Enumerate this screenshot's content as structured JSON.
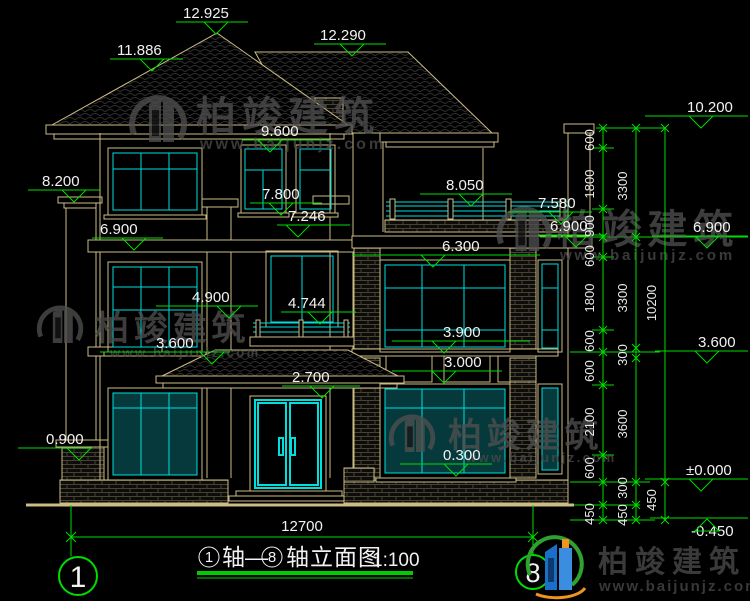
{
  "drawing_title": {
    "axis_left": "1",
    "between": "轴—",
    "axis_right": "8",
    "suffix": "轴立面图",
    "scale": "1:100"
  },
  "axis_bubbles": {
    "left": "1",
    "right": "8"
  },
  "bottom_dim": "12700",
  "elevations": [
    {
      "t": "12.925",
      "x": 183,
      "y": 18,
      "l1": 176,
      "l2": 248,
      "tx": 216
    },
    {
      "t": "11.886",
      "x": 117,
      "y": 55,
      "l1": 110,
      "l2": 183,
      "tx": 152
    },
    {
      "t": "12.290",
      "x": 320,
      "y": 40,
      "l1": 314,
      "l2": 386,
      "tx": 352
    },
    {
      "t": "9.600",
      "x": 261,
      "y": 136,
      "l1": 242,
      "l2": 330,
      "tx": 270
    },
    {
      "t": "8.200",
      "x": 42,
      "y": 186,
      "l1": 28,
      "l2": 100,
      "tx": 74
    },
    {
      "t": "7.800",
      "x": 262,
      "y": 199,
      "l1": 250,
      "l2": 322,
      "tx": 281
    },
    {
      "t": "7.246",
      "x": 288,
      "y": 221,
      "l1": 277,
      "l2": 350,
      "tx": 298
    },
    {
      "t": "8.050",
      "x": 446,
      "y": 190,
      "l1": 420,
      "l2": 512,
      "tx": 471
    },
    {
      "t": "7.580",
      "x": 538,
      "y": 208,
      "l1": 508,
      "l2": 592,
      "tx": 561
    },
    {
      "t": "6.900",
      "x": 100,
      "y": 234,
      "l1": 92,
      "l2": 163,
      "tx": 134
    },
    {
      "t": "6.900",
      "x": 550,
      "y": 231,
      "l1": 538,
      "l2": 606,
      "tx": 576
    },
    {
      "t": "6.900",
      "x": 693,
      "y": 232,
      "l1": 652,
      "l2": 748,
      "tx": 707
    },
    {
      "t": "10.200",
      "x": 687,
      "y": 112,
      "l1": 645,
      "l2": 748,
      "tx": 701
    },
    {
      "t": "6.300",
      "x": 442,
      "y": 251,
      "l1": 352,
      "l2": 540,
      "tx": 433
    },
    {
      "t": "4.900",
      "x": 192,
      "y": 302,
      "l1": 156,
      "l2": 258,
      "tx": 229
    },
    {
      "t": "4.744",
      "x": 288,
      "y": 308,
      "l1": 281,
      "l2": 356,
      "tx": 320
    },
    {
      "t": "3.600",
      "x": 156,
      "y": 348,
      "l1": 100,
      "l2": 230,
      "tx": 212
    },
    {
      "t": "3.900",
      "x": 443,
      "y": 337,
      "l1": 392,
      "l2": 530,
      "tx": 444
    },
    {
      "t": "3.000",
      "x": 444,
      "y": 367,
      "l1": 392,
      "l2": 502,
      "tx": 444
    },
    {
      "t": "2.700",
      "x": 292,
      "y": 382,
      "l1": 282,
      "l2": 360,
      "tx": 322
    },
    {
      "t": "0.900",
      "x": 46,
      "y": 444,
      "l1": 18,
      "l2": 92,
      "tx": 79
    },
    {
      "t": "0.300",
      "x": 443,
      "y": 460,
      "l1": 400,
      "l2": 492,
      "tx": 456
    },
    {
      "t": "±0.000",
      "x": 686,
      "y": 475,
      "l1": 645,
      "l2": 748,
      "tx": 701
    },
    {
      "t": "-0.450",
      "x": 691,
      "y": 536,
      "l1": 650,
      "l2": 748,
      "tx": 707,
      "flip": true
    },
    {
      "t": "3.600",
      "x": 698,
      "y": 347,
      "l1": 655,
      "l2": 748,
      "tx": 707
    }
  ],
  "chains": [
    {
      "x": 603,
      "lx": 594,
      "ticks": [
        128,
        148,
        209,
        237,
        257,
        330,
        352,
        385,
        455,
        482,
        505,
        520
      ],
      "labels": [
        {
          "t": "600",
          "y": 140
        },
        {
          "t": "1800",
          "y": 184
        },
        {
          "t": "900",
          "y": 226
        },
        {
          "t": "600",
          "y": 256
        },
        {
          "t": "1800",
          "y": 298
        },
        {
          "t": "600",
          "y": 341
        },
        {
          "t": "600",
          "y": 371
        },
        {
          "t": "2100",
          "y": 422
        },
        {
          "t": "600",
          "y": 468
        },
        {
          "t": "450",
          "y": 514
        }
      ]
    },
    {
      "x": 636,
      "lx": 627,
      "ticks": [
        128,
        237,
        348,
        358,
        482,
        505,
        520
      ],
      "labels": [
        {
          "t": "3300",
          "y": 186
        },
        {
          "t": "3300",
          "y": 298
        },
        {
          "t": "300",
          "y": 355
        },
        {
          "t": "3600",
          "y": 424
        },
        {
          "t": "300",
          "y": 488
        },
        {
          "t": "450",
          "y": 515
        }
      ]
    },
    {
      "x": 665,
      "lx": 656,
      "ticks": [
        128,
        482,
        520
      ],
      "labels": [
        {
          "t": "10200",
          "y": 303
        },
        {
          "t": "450",
          "y": 500
        }
      ]
    }
  ],
  "watermark": {
    "brand": "柏竣建筑",
    "url": "www.baijunjz.com",
    "spots": [
      {
        "ix": 158,
        "iy": 122,
        "is": 1.0,
        "bx": 196,
        "by": 130,
        "bfs": 40,
        "ux": 200,
        "uy": 149,
        "ufs": 16
      },
      {
        "ix": 524,
        "iy": 232,
        "is": 0.95,
        "bx": 556,
        "by": 243,
        "bfs": 40,
        "ux": 560,
        "uy": 260,
        "ufs": 15
      },
      {
        "ix": 412,
        "iy": 436,
        "is": 0.8,
        "bx": 448,
        "by": 447,
        "bfs": 34,
        "ux": 466,
        "uy": 462,
        "ufs": 13
      },
      {
        "ix": 60,
        "iy": 327,
        "is": 0.8,
        "bx": 95,
        "by": 340,
        "bfs": 34,
        "ux": 110,
        "uy": 357,
        "ufs": 13
      }
    ]
  },
  "logo": {
    "brand": "柏竣建筑",
    "url": "www.baijunjz.com"
  },
  "colors": {
    "background": "#000000",
    "wall_line": "#CDBC84",
    "glass_cyan": "#00DEDE",
    "dimension_green": "#00DD00",
    "text_white": "#F2F2F2",
    "watermark_gray": "#4F4F4F",
    "logo_blue": "#1A6FC9",
    "logo_green": "#2FA12F",
    "logo_orange": "#F0941E"
  }
}
